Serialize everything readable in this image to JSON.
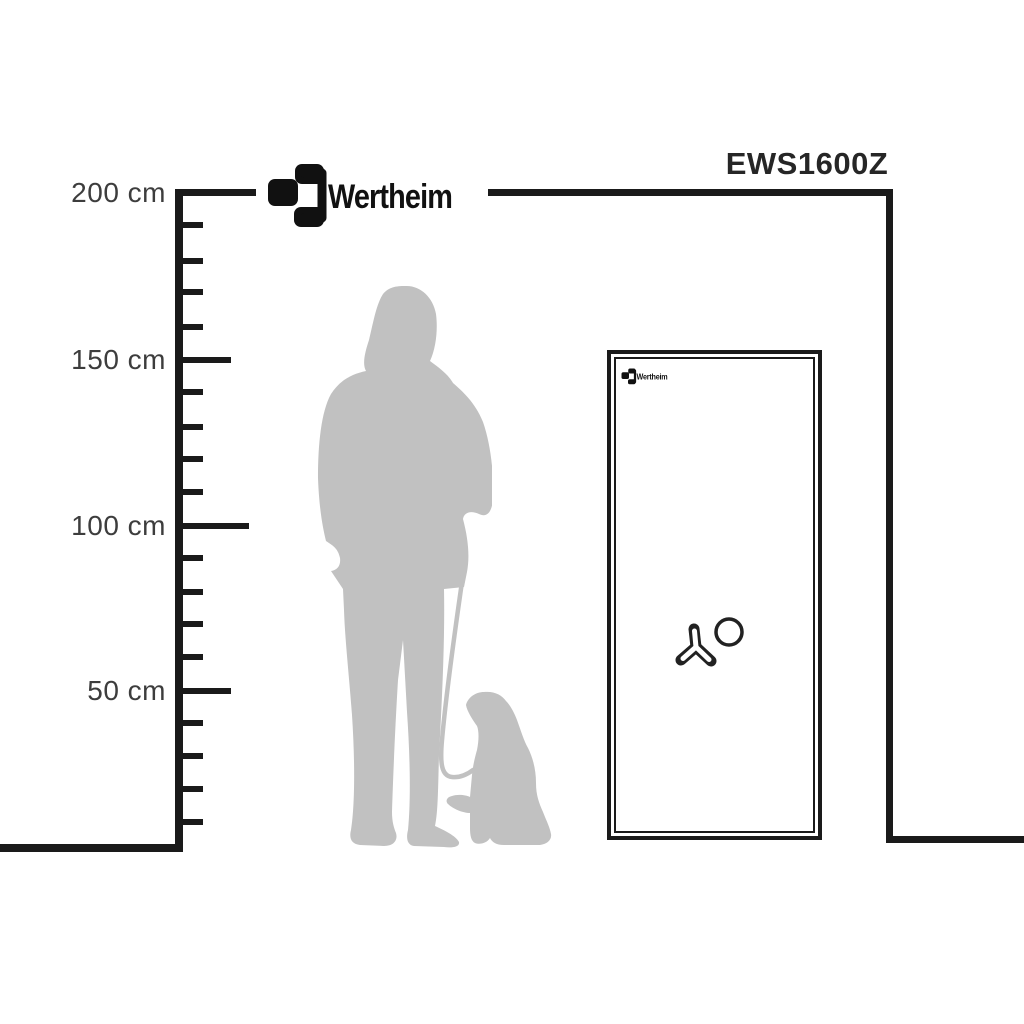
{
  "page": {
    "description": "Wertheim safe EWS1600Z size comparison diagram with measurement scale, person and dog silhouettes"
  },
  "header": {
    "brand_logo_text": "Wertheim",
    "model_label": "EWS1600Z"
  },
  "ruler": {
    "unit": "cm",
    "tick_interval_cm": 10,
    "max_cm": 200,
    "labels": [
      {
        "text": "200 cm",
        "value_cm": 200
      },
      {
        "text": "150 cm",
        "value_cm": 150
      },
      {
        "text": "100 cm",
        "value_cm": 100
      },
      {
        "text": "50 cm",
        "value_cm": 50
      }
    ]
  },
  "safe": {
    "door_logo_text": "Wertheim",
    "model": "EWS1600Z",
    "approx_height_cm": 150,
    "features": [
      "tri-spoke-handle",
      "dial-knob",
      "double-frame-door"
    ]
  },
  "figures": {
    "person": "standing-adult-silhouette",
    "dog": "sitting-dog-silhouette",
    "leash": "dog-leash"
  },
  "colors": {
    "line": "#1a1a1a",
    "label_text": "#3d3d3d",
    "model_text": "#262626",
    "silhouette": "#c1c1c1",
    "background": "#ffffff"
  }
}
